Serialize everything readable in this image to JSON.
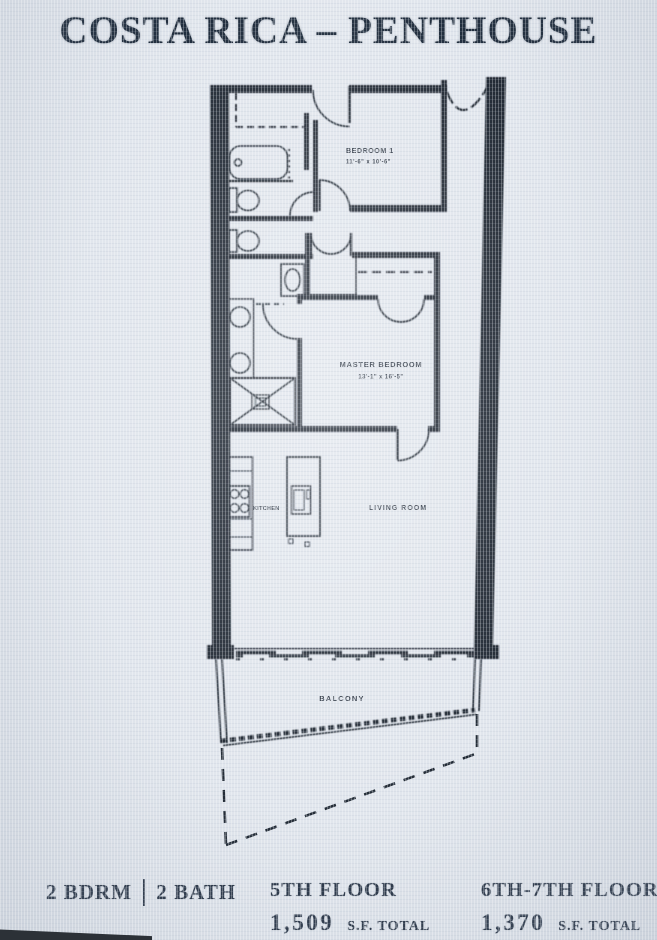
{
  "title": "COSTA RICA – PENTHOUSE",
  "plan": {
    "rooms": {
      "bedroom1": {
        "name": "BEDROOM 1",
        "dims": "11'-6\" x 10'-6\""
      },
      "master": {
        "name": "MASTER BEDROOM",
        "dims": "13'-1\" x 16'-5\""
      },
      "kitchen": {
        "name": "KITCHEN"
      },
      "living": {
        "name": "LIVING ROOM"
      },
      "balcony": {
        "name": "BALCONY"
      }
    }
  },
  "footer": {
    "bedrooms": "2 BDRM",
    "baths": "2 BATH",
    "floors": [
      {
        "label": "5TH FLOOR",
        "area": "1,509",
        "unit": "S.F. TOTAL"
      },
      {
        "label": "6TH-7TH FLOORS",
        "area": "1,370",
        "unit": "S.F. TOTAL"
      }
    ]
  },
  "colors": {
    "background": "#e1e6ed",
    "ink": "#222b36",
    "title_ink": "#202d3d"
  }
}
